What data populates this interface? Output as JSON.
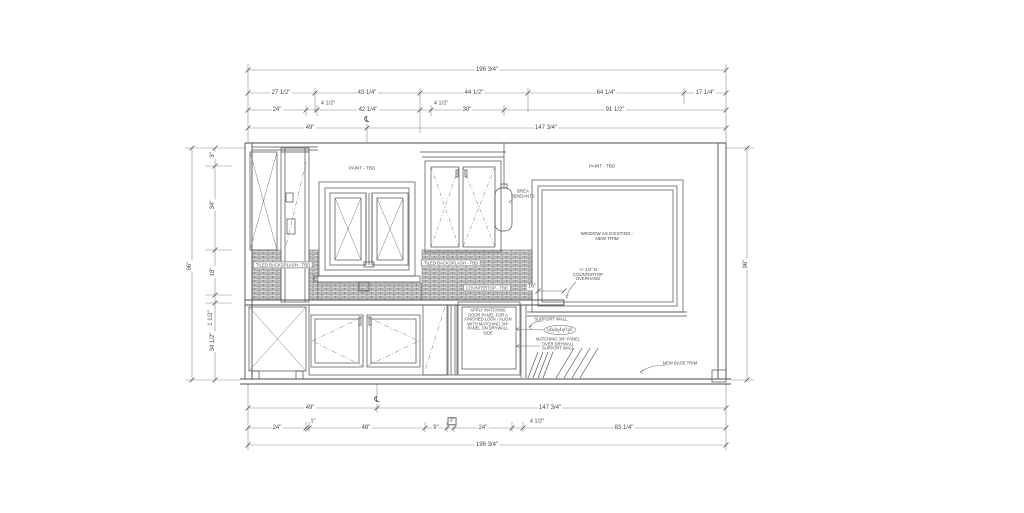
{
  "dims": {
    "top_row1": [
      "196 3/4\""
    ],
    "top_row2": [
      "27 1/2\"",
      "43 1/4\"",
      "44 1/2\"",
      "64 1/4\"",
      "17 1/4\""
    ],
    "top_row3": [
      "24\"",
      "4 1/2\"",
      "42 1/4\"",
      "4 1/2\"",
      "30\"",
      "91 1/2\""
    ],
    "top_row4": [
      "49\"",
      "147 3/4\""
    ],
    "bottom_row1": [
      "49\"",
      "147 3/4\""
    ],
    "bottom_row2": [
      "24\"",
      "1\"",
      "48\"",
      "9\"",
      "3\"",
      "24\"",
      "4 1/2\"",
      "83 1/4\""
    ],
    "bottom_row3": [
      "196 3/4\""
    ],
    "left_col": [
      "3\"",
      "34\"",
      "18\"",
      "1 1/2\"",
      "34 1/2\""
    ],
    "left_overall": "96\"",
    "right_overall": "96\"",
    "countertop_overhang": "16\"",
    "centerline_symbol": "℄"
  },
  "annotations": {
    "paint_left": "PAINT - TBD",
    "paint_right": "PAINT - TBD",
    "window_existing": "WINDOW AS EXISTING -\nNEW TRIM",
    "tiled_backsplash_left": "TILED BACKSPLASH - TBD",
    "tiled_backsplash_center": "TILED BACKSPLASH - TBD",
    "countertop": "COUNTERTOP - TBD",
    "pendants": "BREA\nPENDANTS",
    "overhang_note": "+/- 1/2\" D\nCOUNTERTOP\nOVERHANG",
    "door_panel_note": "APPLY MATCHING\nDOOR PANEL FOR A\nFINISHED LOOK / ALIGN\nWITH MATCHING 3/4\"\nPANEL ON DRYWALL\nSIDE",
    "support_wall": "SUPPORT WALL",
    "stud_note": "2 X6 @ 16\" O.C.",
    "matching_panel_note": "MATCHING 3/4\" PANEL\nOVER DRYWALL\nSUPPORT WALL",
    "base_trim": "NEW BASE TRIM"
  },
  "colors": {
    "line": "#4d4d4d",
    "dim_line": "#8a8a8a",
    "text": "#4a4a4a",
    "tile_fill": "#d8d8d8",
    "background": "#ffffff"
  }
}
